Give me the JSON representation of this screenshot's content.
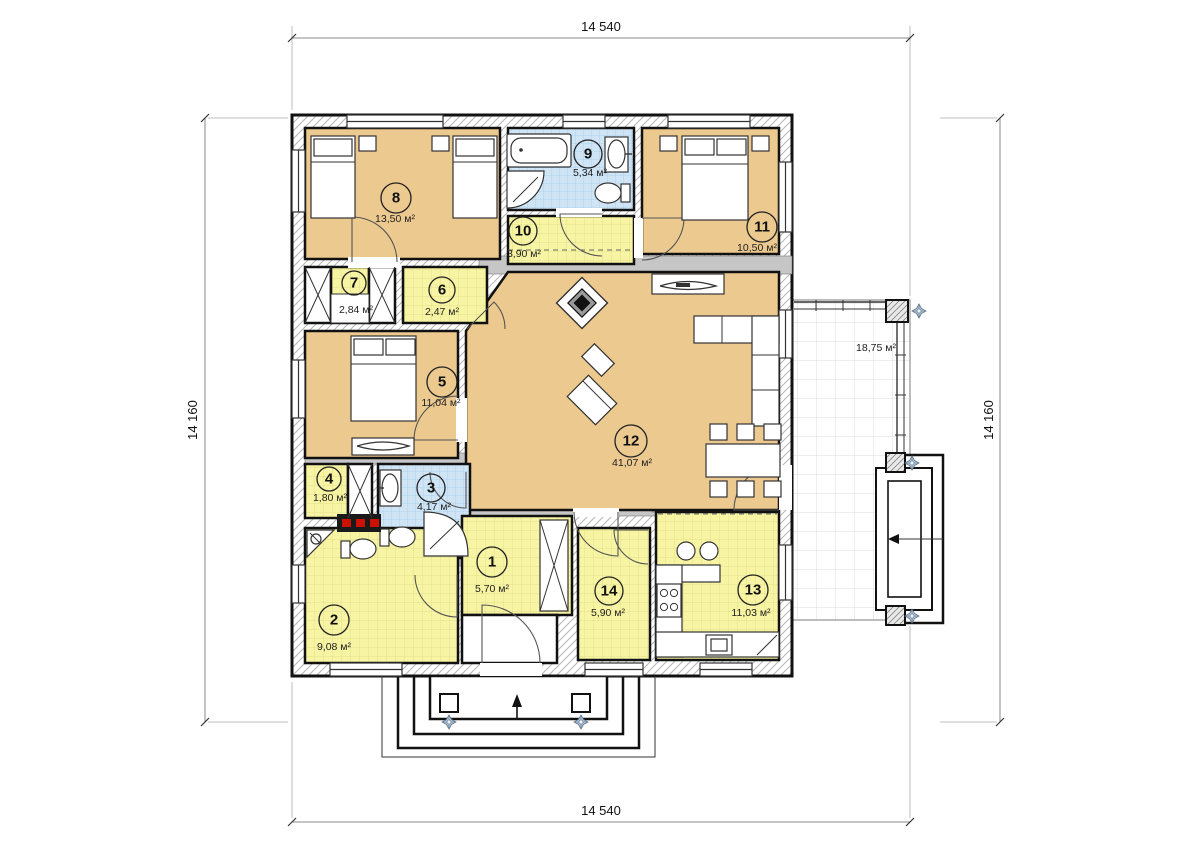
{
  "title": "Floor plan — single-storey house",
  "dimensions": {
    "top": "14 540",
    "bottom": "14 540",
    "left": "14 160",
    "right": "14 160"
  },
  "rooms": [
    {
      "number": "1",
      "area": "5,70 м²"
    },
    {
      "number": "2",
      "area": "9,08 м²"
    },
    {
      "number": "3",
      "area": "4,17 м²"
    },
    {
      "number": "4",
      "area": "1,80 м²"
    },
    {
      "number": "5",
      "area": "11,04 м²"
    },
    {
      "number": "6",
      "area": "2,47 м²"
    },
    {
      "number": "7",
      "area": "2,84 м²"
    },
    {
      "number": "8",
      "area": "13,50 м²"
    },
    {
      "number": "9",
      "area": "5,34 м²"
    },
    {
      "number": "10",
      "area": "3,90 м²"
    },
    {
      "number": "11",
      "area": "10,50 м²"
    },
    {
      "number": "12",
      "area": "41,07 м²"
    },
    {
      "number": "13",
      "area": "11,03 м²"
    },
    {
      "number": "14",
      "area": "5,90 м²"
    }
  ],
  "terrace": {
    "area": "18,75 м²"
  },
  "colors": {
    "room_tan": "#ecc98f",
    "room_yellow": "#f7f4a3",
    "room_blue": "#cfe5f5",
    "wall": "#111111",
    "boiler_red": "#cc1100"
  }
}
